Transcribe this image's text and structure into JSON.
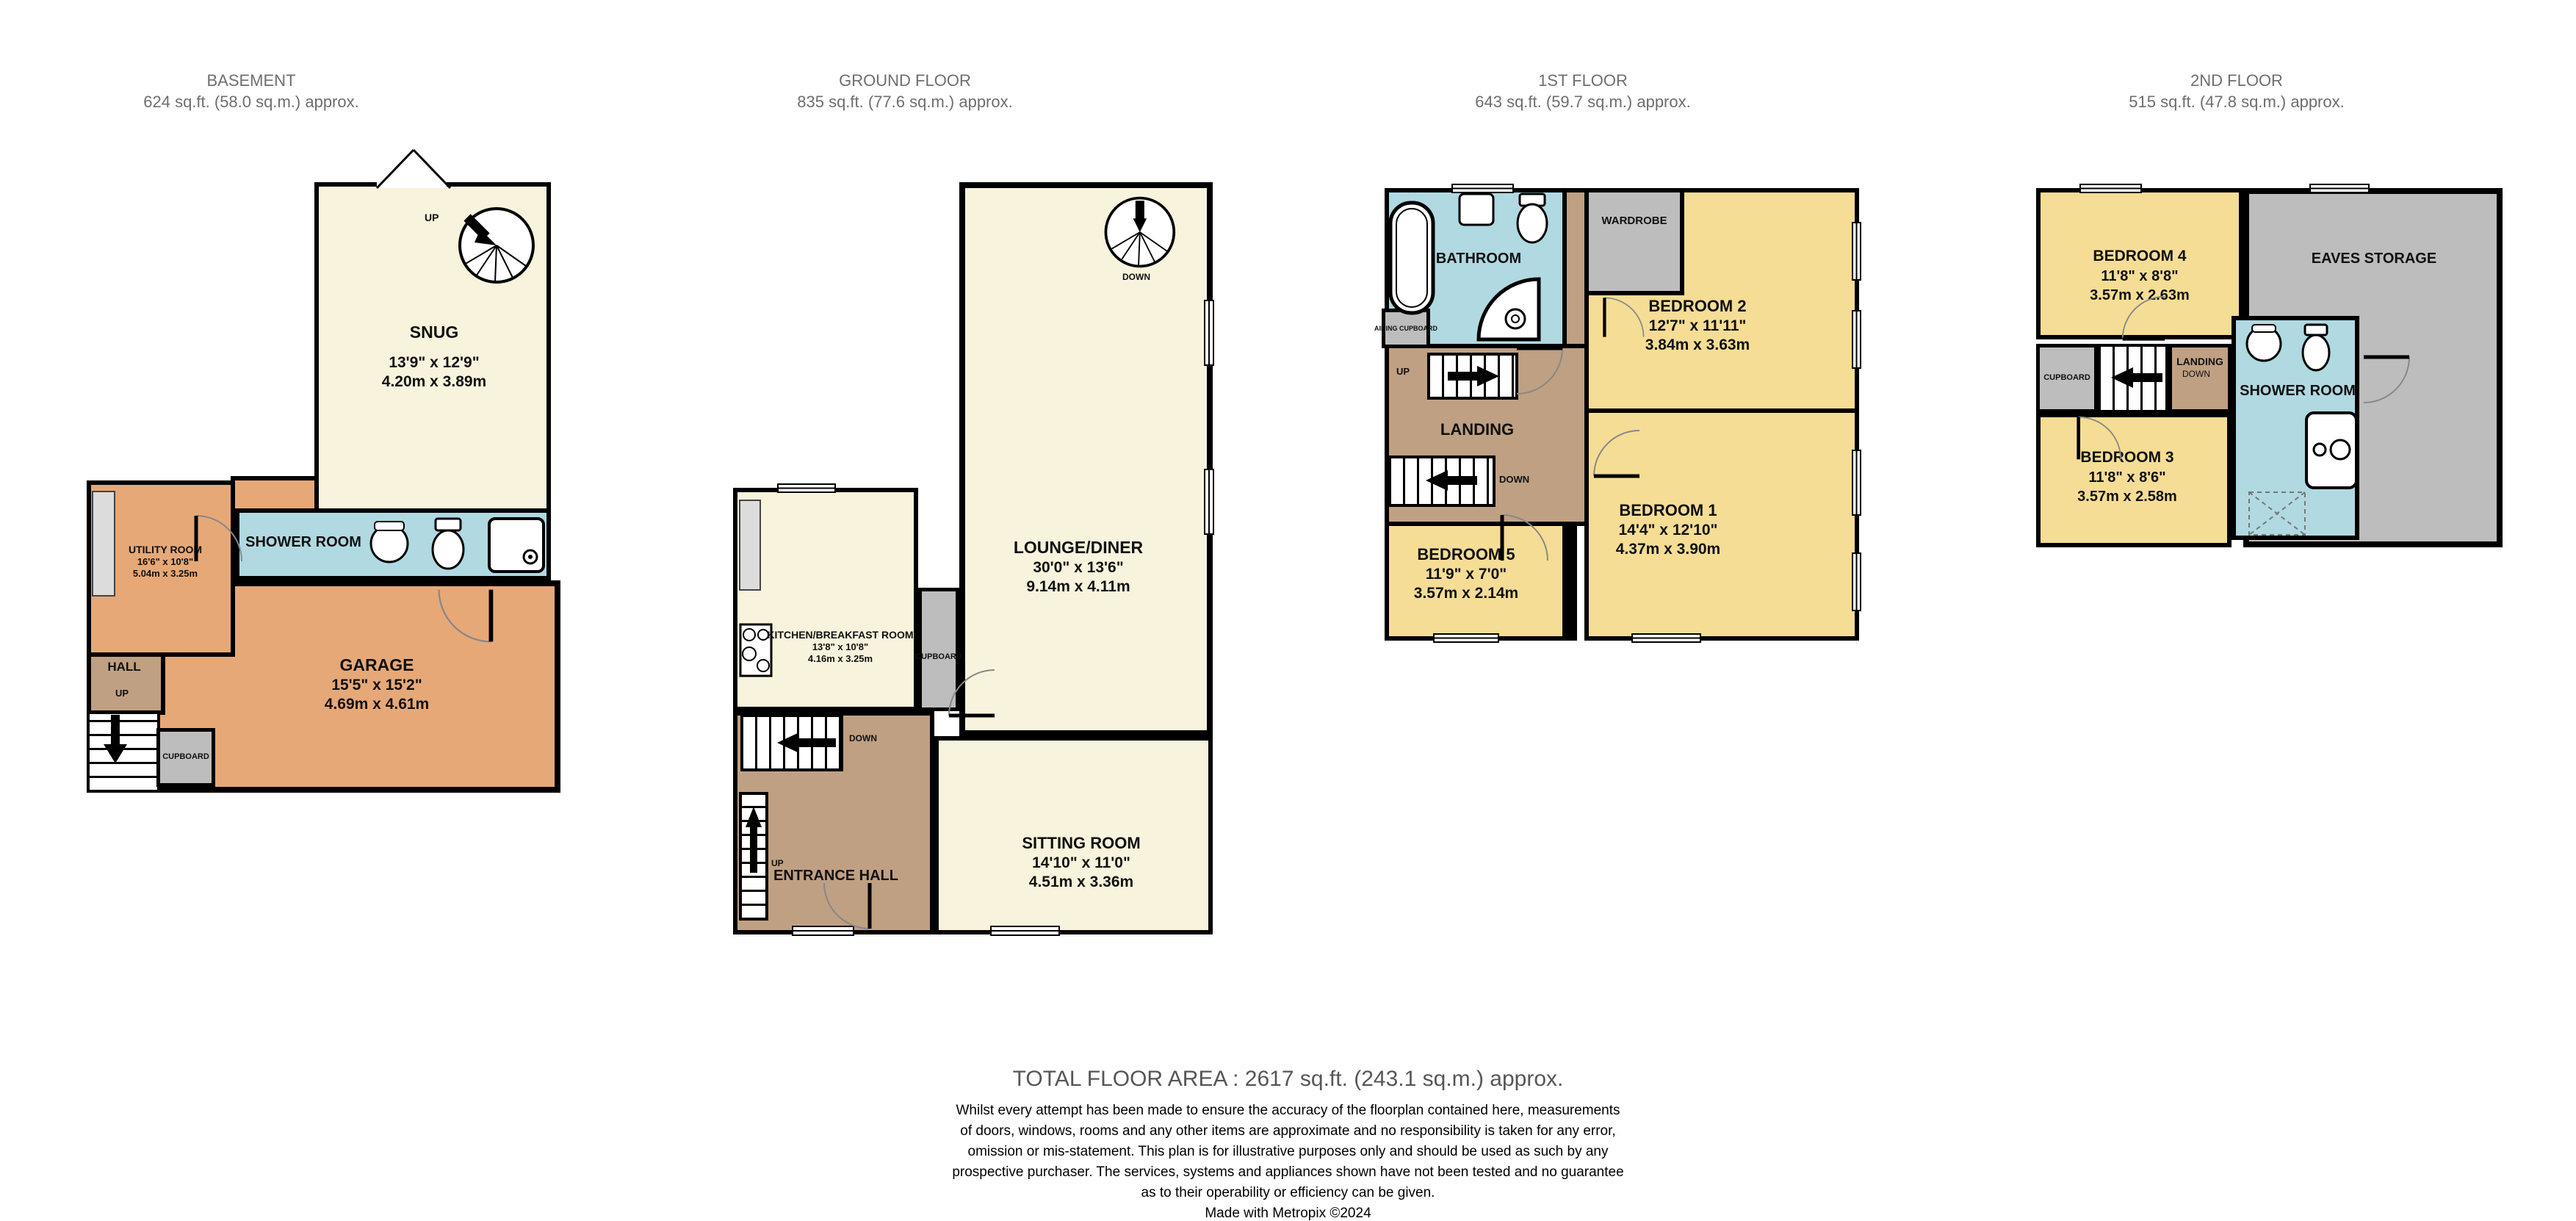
{
  "colors": {
    "cream": "#f8f3dc",
    "yellow": "#f6dd95",
    "orange": "#e7a877",
    "blue": "#b0d9e2",
    "tan": "#bfa083",
    "gray": "#bdbdbd",
    "wall": "#000000",
    "header_text": "#6e6e6e",
    "total_text": "#565656"
  },
  "floors": [
    {
      "title": "BASEMENT",
      "area": "624 sq.ft. (58.0 sq.m.) approx.",
      "rooms": {
        "snug": {
          "name": "SNUG",
          "ft": "13'9\"  x 12'9\"",
          "m": "4.20m  x 3.89m"
        },
        "shower": {
          "name": "SHOWER ROOM"
        },
        "utility": {
          "name": "UTILITY ROOM",
          "ft": "16'6\"  x 10'8\"",
          "m": "5.04m  x 3.25m"
        },
        "hall": {
          "name": "HALL",
          "up": "UP"
        },
        "cupboard": {
          "name": "CUPBOARD"
        },
        "garage": {
          "name": "GARAGE",
          "ft": "15'5\"  x 15'2\"",
          "m": "4.69m  x 4.61m"
        },
        "stairs_up": "UP"
      }
    },
    {
      "title": "GROUND FLOOR",
      "area": "835 sq.ft. (77.6 sq.m.) approx.",
      "rooms": {
        "lounge": {
          "name": "LOUNGE/DINER",
          "ft": "30'0\"  x 13'6\"",
          "m": "9.14m  x 4.11m",
          "down": "DOWN"
        },
        "kitchen": {
          "name": "KITCHEN/BREAKFAST ROOM",
          "ft": "13'8\"  x 10'8\"",
          "m": "4.16m  x 3.25m"
        },
        "cupboard": {
          "name": "CUPBOARD"
        },
        "entrance": {
          "name": "ENTRANCE HALL",
          "down": "DOWN",
          "up": "UP"
        },
        "sitting": {
          "name": "SITTING ROOM",
          "ft": "14'10\"  x 11'0\"",
          "m": "4.51m  x 3.36m"
        }
      }
    },
    {
      "title": "1ST FLOOR",
      "area": "643 sq.ft. (59.7 sq.m.) approx.",
      "rooms": {
        "bathroom": {
          "name": "BATHROOM"
        },
        "airing": {
          "name": "AIRING CUPBOARD"
        },
        "wardrobe": {
          "name": "WARDROBE"
        },
        "bed2": {
          "name": "BEDROOM 2",
          "ft": "12'7\"  x 11'11\"",
          "m": "3.84m  x 3.63m"
        },
        "landing": {
          "name": "LANDING",
          "up": "UP",
          "down": "DOWN"
        },
        "bed1": {
          "name": "BEDROOM 1",
          "ft": "14'4\"  x 12'10\"",
          "m": "4.37m  x 3.90m"
        },
        "bed5": {
          "name": "BEDROOM 5",
          "ft": "11'9\"  x 7'0\"",
          "m": "3.57m  x 2.14m"
        }
      }
    },
    {
      "title": "2ND FLOOR",
      "area": "515 sq.ft. (47.8 sq.m.) approx.",
      "rooms": {
        "bed4": {
          "name": "BEDROOM 4",
          "ft": "11'8\"  x 8'8\"",
          "m": "3.57m  x 2.63m"
        },
        "eaves": {
          "name": "EAVES STORAGE"
        },
        "cupboard": {
          "name": "CUPBOARD"
        },
        "landing": {
          "name": "LANDING",
          "down": "DOWN"
        },
        "shower": {
          "name": "SHOWER ROOM"
        },
        "bed3": {
          "name": "BEDROOM 3",
          "ft": "11'8\"  x 8'6\"",
          "m": "3.57m  x 2.58m"
        }
      }
    }
  ],
  "footer": {
    "total": "TOTAL FLOOR AREA : 2617 sq.ft. (243.1 sq.m.) approx.",
    "disclaimer_lines": [
      "Whilst every attempt has been made to ensure the accuracy of the floorplan contained here, measurements",
      "of doors, windows, rooms and any other items are approximate and no responsibility is taken for any error,",
      "omission or mis-statement. This plan is for illustrative purposes only and should be used as such by any",
      "prospective purchaser. The services, systems and appliances shown have not been tested and no guarantee",
      "as to their operability or efficiency can be given.",
      "Made with Metropix ©2024"
    ]
  }
}
